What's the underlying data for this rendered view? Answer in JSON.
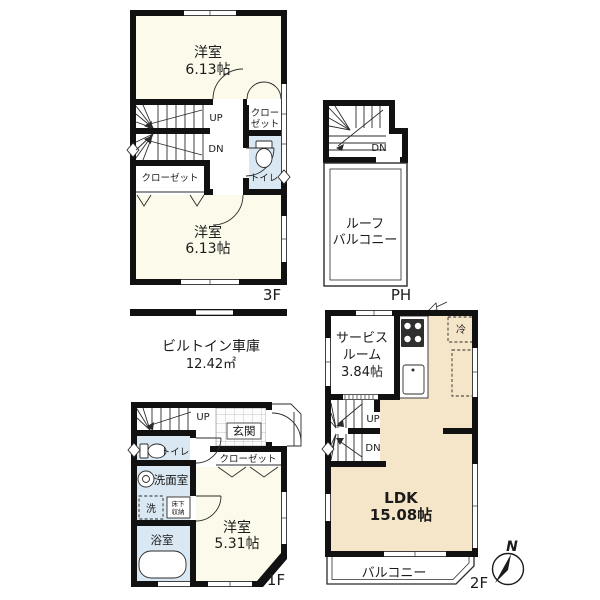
{
  "colors": {
    "wall": "#111111",
    "room_cream": "#fcfaea",
    "wet_blue": "#d9e8f2",
    "ldk_peach": "#f6e6c9",
    "line": "#2b2b2b"
  },
  "floor_3f": {
    "floor_label": "3F",
    "room_top_name": "洋室",
    "room_top_size": "6.13帖",
    "room_bottom_name": "洋室",
    "room_bottom_size": "6.13帖",
    "closet_upper_l1": "クロー",
    "closet_upper_l2": "ゼット",
    "closet_lower": "クローゼット",
    "toilet": "トイレ",
    "up": "UP",
    "dn": "DN"
  },
  "floor_ph": {
    "floor_label": "PH",
    "dn": "DN",
    "roof_balcony_l1": "ルーフ",
    "roof_balcony_l2": "バルコニー"
  },
  "floor_1f": {
    "floor_label": "1F",
    "garage_name": "ビルトイン車庫",
    "garage_size": "12.42㎡",
    "up": "UP",
    "entrance": "玄関",
    "closet": "クローゼット",
    "toilet": "トイレ",
    "washroom": "洗面室",
    "washer": "洗",
    "underfloor_l1": "床下",
    "underfloor_l2": "収納",
    "bathroom": "浴室",
    "room_name": "洋室",
    "room_size": "5.31帖"
  },
  "floor_2f": {
    "floor_label": "2F",
    "service_l1": "サービス",
    "service_l2": "ルーム",
    "service_l3": "3.84帖",
    "fridge": "冷",
    "up": "UP",
    "dn": "DN",
    "ldk_name": "LDK",
    "ldk_size": "15.08帖",
    "balcony": "バルコニー"
  },
  "compass": {
    "north": "N"
  }
}
